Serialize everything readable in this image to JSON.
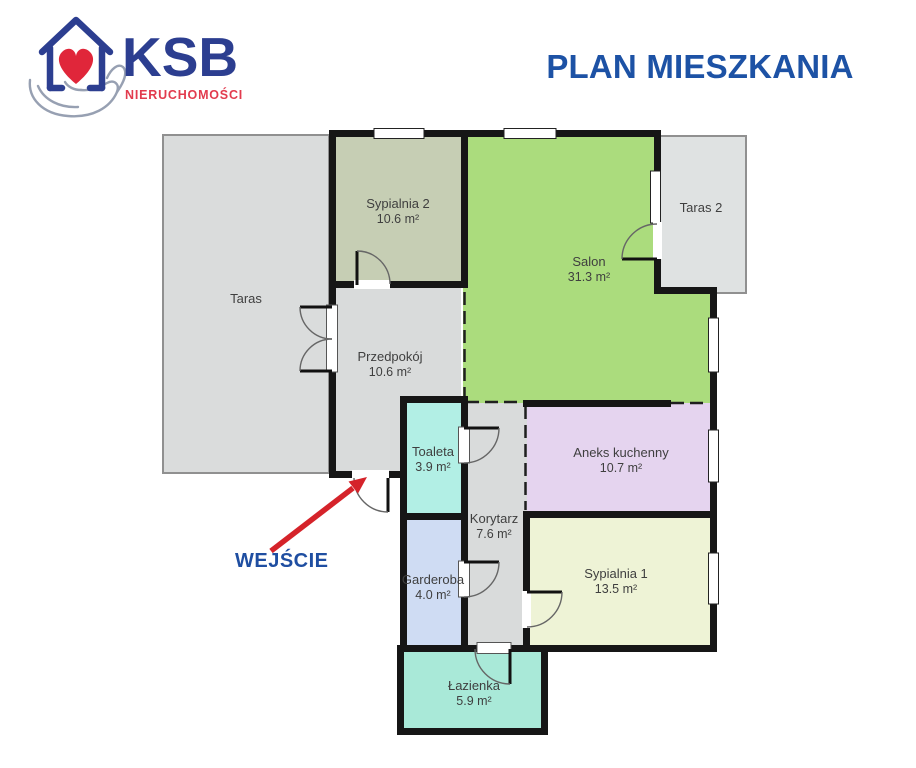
{
  "header": {
    "logo": {
      "brand": "KSB",
      "subtitle": "NIERUCHOMOŚCI"
    },
    "title": "PLAN MIESZKANIA"
  },
  "entrance_label": "WEJŚCIE",
  "colors": {
    "title_blue": "#1d52a5",
    "brand_blue": "#2c3e90",
    "brand_red": "#e23b4e",
    "arrow_red": "#d5232a",
    "wall_black": "#161616",
    "terrace_border_gray": "#909090"
  },
  "rooms": [
    {
      "name": "Taras",
      "color": "#dadcdc"
    },
    {
      "name": "Sypialnia 2",
      "area": "10.6 m²",
      "color": "#c6ceb4"
    },
    {
      "name": "Salon",
      "area": "31.3 m²",
      "color": "#abdc7d"
    },
    {
      "name": "Taras 2",
      "color": "#dfe2e2"
    },
    {
      "name": "Przedpokój",
      "area": "10.6 m²",
      "color": "#d9dbdb"
    },
    {
      "name": "Toaleta",
      "area": "3.9 m²",
      "color": "#b2efe5"
    },
    {
      "name": "Aneks kuchenny",
      "area": "10.7 m²",
      "color": "#e5d4ef"
    },
    {
      "name": "Korytarz",
      "area": "7.6 m²",
      "color": "#d9dbdb"
    },
    {
      "name": "Sypialnia 1",
      "area": "13.5 m²",
      "color": "#eef3d6"
    },
    {
      "name": "Garderoba",
      "area": "4.0 m²",
      "color": "#cfdcf3"
    },
    {
      "name": "Łazienka",
      "area": "5.9 m²",
      "color": "#a9e9d8"
    }
  ]
}
